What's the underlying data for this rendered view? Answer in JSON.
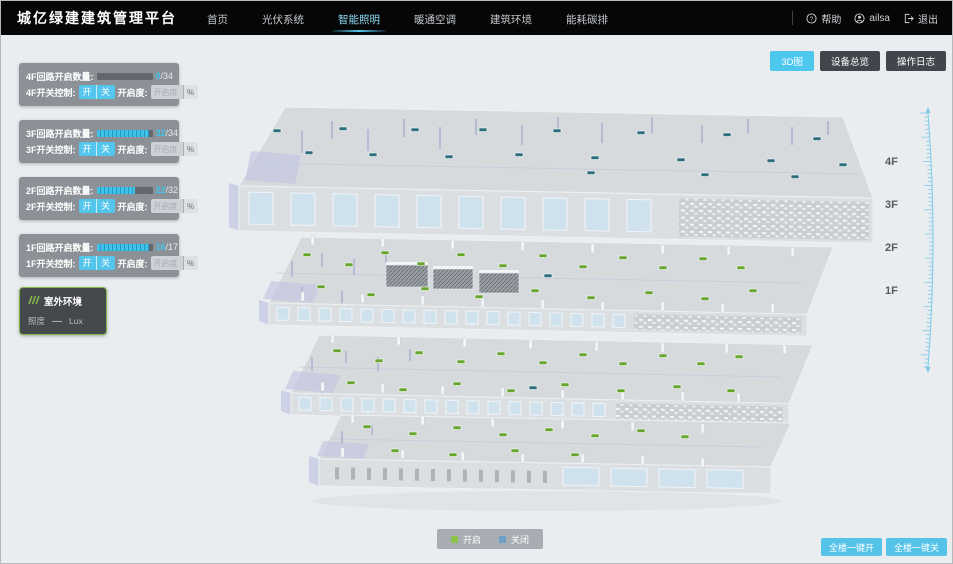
{
  "header": {
    "brand": "城亿绿建建筑管理平台",
    "nav": [
      {
        "label": "首页",
        "active": false
      },
      {
        "label": "光伏系统",
        "active": false
      },
      {
        "label": "智能照明",
        "active": true
      },
      {
        "label": "暖通空调",
        "active": false
      },
      {
        "label": "建筑环境",
        "active": false
      },
      {
        "label": "能耗碳排",
        "active": false
      }
    ],
    "help_label": "帮助",
    "user_name": "ailsa",
    "logout_label": "退出"
  },
  "floor_panels": [
    {
      "floor": "4F",
      "count_label": "4F回路开启数量:",
      "open": 0,
      "total": 34,
      "switch_label": "4F开关控制:",
      "on_label": "开",
      "off_label": "关",
      "dim_label": "开启度:",
      "dim_placeholder": "开启度",
      "percent_label": "%"
    },
    {
      "floor": "3F",
      "count_label": "3F回路开启数量:",
      "open": 32,
      "total": 34,
      "switch_label": "3F开关控制:",
      "on_label": "开",
      "off_label": "关",
      "dim_label": "开启度:",
      "dim_placeholder": "开启度",
      "percent_label": "%"
    },
    {
      "floor": "2F",
      "count_label": "2F回路开启数量:",
      "open": 22,
      "total": 32,
      "switch_label": "2F开关控制:",
      "on_label": "开",
      "off_label": "关",
      "dim_label": "开启度:",
      "dim_placeholder": "开启度",
      "percent_label": "%"
    },
    {
      "floor": "1F",
      "count_label": "1F回路开启数量:",
      "open": 16,
      "total": 17,
      "switch_label": "1F开关控制:",
      "on_label": "开",
      "off_label": "关",
      "dim_label": "开启度:",
      "dim_placeholder": "开启度",
      "percent_label": "%"
    }
  ],
  "outdoor_panel": {
    "title": "室外环境",
    "metric_label": "照度",
    "metric_value": "—",
    "metric_unit": "Lux"
  },
  "view_buttons": [
    {
      "label": "3D图",
      "active": true
    },
    {
      "label": "设备总览",
      "active": false
    },
    {
      "label": "操作日志",
      "active": false
    }
  ],
  "floor_scale_labels": [
    "4F",
    "3F",
    "2F",
    "1F"
  ],
  "legend": {
    "items": [
      {
        "label": "开启",
        "color": "#8bc34a"
      },
      {
        "label": "关闭",
        "color": "#6d9ec7"
      }
    ]
  },
  "bulk_buttons": [
    {
      "label": "全楼一键开"
    },
    {
      "label": "全楼一键关"
    }
  ],
  "colors": {
    "accent": "#4ec7ee",
    "marker_on": "#67a62f",
    "marker_off": "#2e6f7e"
  },
  "building": {
    "floors": [
      {
        "label": "4F",
        "marker_color": "#2e6f7e",
        "markers": [
          [
            272,
            128
          ],
          [
            304,
            150
          ],
          [
            338,
            126
          ],
          [
            368,
            152
          ],
          [
            410,
            127
          ],
          [
            444,
            154
          ],
          [
            478,
            127
          ],
          [
            514,
            152
          ],
          [
            552,
            128
          ],
          [
            590,
            155
          ],
          [
            636,
            130
          ],
          [
            676,
            157
          ],
          [
            722,
            132
          ],
          [
            766,
            158
          ],
          [
            812,
            136
          ],
          [
            838,
            162
          ],
          [
            586,
            170
          ],
          [
            700,
            172
          ],
          [
            790,
            174
          ]
        ],
        "alt_markers": []
      },
      {
        "label": "3F",
        "marker_color": "#67a62f",
        "markers": [
          [
            302,
            252
          ],
          [
            344,
            262
          ],
          [
            380,
            250
          ],
          [
            416,
            261
          ],
          [
            456,
            252
          ],
          [
            498,
            263
          ],
          [
            538,
            253
          ],
          [
            578,
            264
          ],
          [
            618,
            255
          ],
          [
            658,
            265
          ],
          [
            698,
            256
          ],
          [
            736,
            265
          ],
          [
            316,
            284
          ],
          [
            366,
            292
          ],
          [
            420,
            286
          ],
          [
            474,
            294
          ],
          [
            530,
            288
          ],
          [
            586,
            295
          ],
          [
            644,
            290
          ],
          [
            700,
            296
          ],
          [
            748,
            288
          ]
        ],
        "alt_markers": [
          [
            543,
            273
          ]
        ]
      },
      {
        "label": "2F",
        "marker_color": "#67a62f",
        "markers": [
          [
            332,
            348
          ],
          [
            374,
            358
          ],
          [
            414,
            350
          ],
          [
            456,
            359
          ],
          [
            496,
            351
          ],
          [
            538,
            360
          ],
          [
            578,
            352
          ],
          [
            618,
            361
          ],
          [
            658,
            353
          ],
          [
            696,
            361
          ],
          [
            734,
            354
          ],
          [
            346,
            380
          ],
          [
            398,
            387
          ],
          [
            452,
            381
          ],
          [
            506,
            388
          ],
          [
            560,
            382
          ],
          [
            616,
            388
          ],
          [
            672,
            384
          ],
          [
            726,
            388
          ]
        ],
        "alt_markers": [
          [
            528,
            385
          ]
        ]
      },
      {
        "label": "1F",
        "marker_color": "#67a62f",
        "markers": [
          [
            362,
            424
          ],
          [
            408,
            431
          ],
          [
            452,
            425
          ],
          [
            498,
            432
          ],
          [
            544,
            427
          ],
          [
            590,
            433
          ],
          [
            636,
            428
          ],
          [
            680,
            434
          ],
          [
            390,
            448
          ],
          [
            448,
            452
          ],
          [
            510,
            448
          ],
          [
            570,
            452
          ]
        ],
        "alt_markers": []
      }
    ]
  }
}
